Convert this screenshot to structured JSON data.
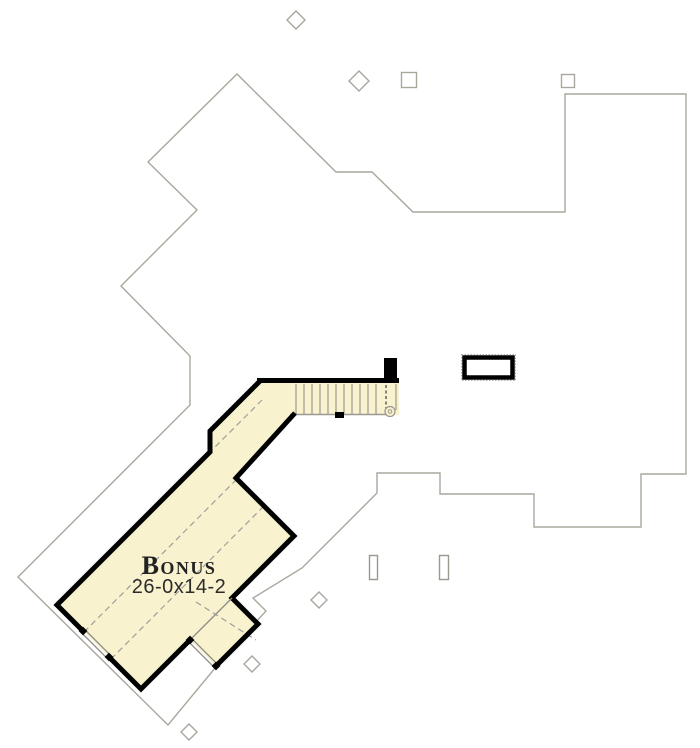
{
  "plan": {
    "title": "Second floor bonus room plan",
    "room": {
      "label": "Bonus",
      "dimensions": "26-0x14-2"
    },
    "features": {
      "staircase": "stair run with railing curl and up-direction dashed line",
      "chimney": "masonry chimney outline",
      "windows": 2,
      "roof_vents": 2,
      "diamond_markers": 5,
      "square_markers": 2
    },
    "colors": {
      "room_fill": "#f8f2cf",
      "wall": "#000000",
      "roofline": "#a9a79d",
      "dashed_line": "#a09f97",
      "label_text": "#222222"
    }
  }
}
